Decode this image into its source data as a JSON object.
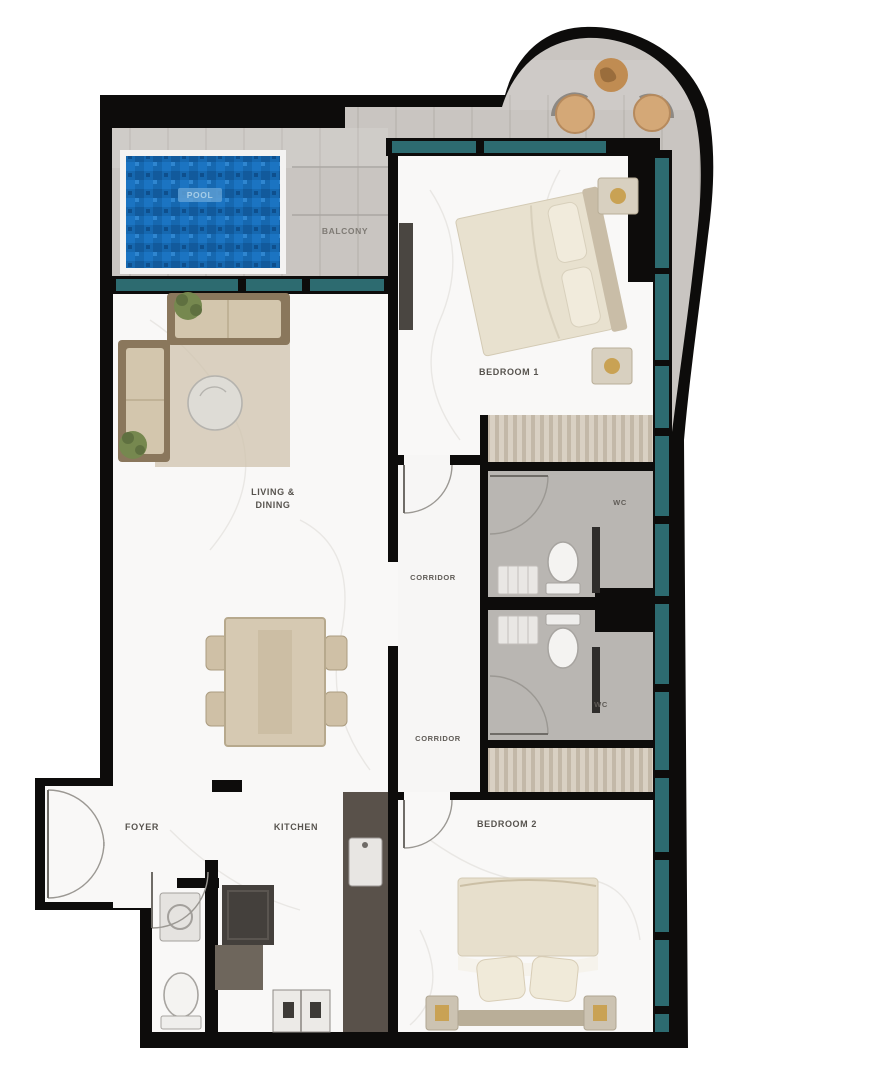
{
  "floor_plan": {
    "title": "apartment-floor-plan",
    "rooms": {
      "balcony": {
        "label": "BALCONY"
      },
      "pool": {
        "label": "POOL"
      },
      "bedroom_1": {
        "label": "BEDROOM 1"
      },
      "bedroom_2": {
        "label": "BEDROOM 2"
      },
      "living_dining": {
        "label_line1": "LIVING &",
        "label_line2": "DINING"
      },
      "corridor_upper": {
        "label": "CORRIDOR"
      },
      "corridor_lower": {
        "label": "CORRIDOR"
      },
      "kitchen": {
        "label": "KITCHEN"
      },
      "foyer": {
        "label": "FOYER"
      },
      "bathroom_1": {
        "label": "WC"
      },
      "bathroom_2": {
        "label": "WC"
      }
    },
    "colors": {
      "wall_black": "#0d0c0b",
      "window_teal": "#2d6b70",
      "pool_blue": "#1668b0",
      "deck_wood_gray": "#c9c5c1",
      "bathroom_gray": "#b9b6b2",
      "furniture_beige": "#d9cdb8",
      "counter_dark": "#59514a",
      "accent_gold": "#c9a254",
      "floor_white": "#f9f8f7"
    }
  }
}
